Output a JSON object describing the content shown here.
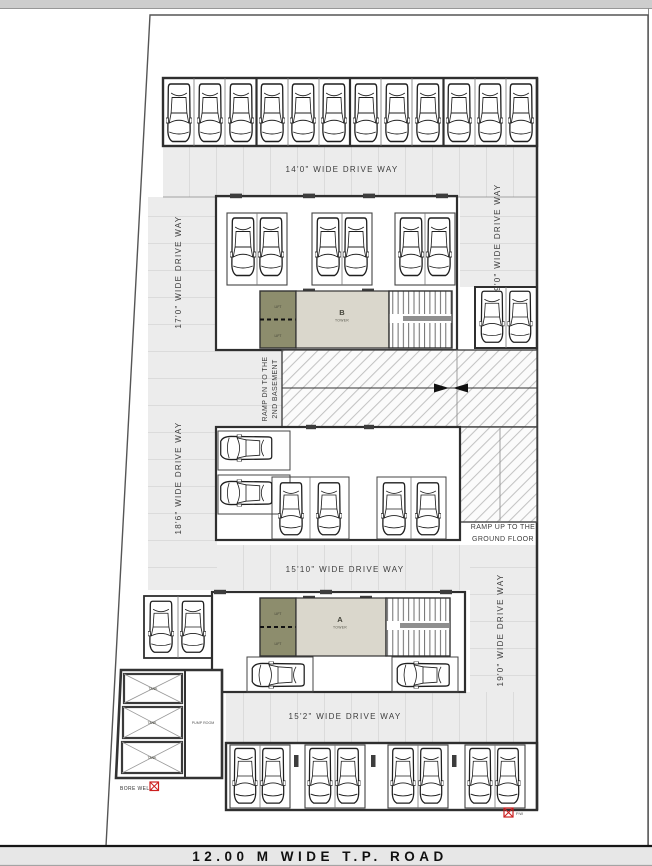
{
  "site": {
    "road_label": "12.00 M WIDE T.P. ROAD",
    "driveways": {
      "top": "14'0\" WIDE DRIVE WAY",
      "left_upper": "17'0\" WIDE DRIVE WAY",
      "left_lower": "18'6\" WIDE DRIVE WAY",
      "right_upper": "19'0\" WIDE DRIVE WAY",
      "right_lower": "19'0\" WIDE DRIVE WAY",
      "middle": "15'10\" WIDE DRIVE WAY",
      "bottom": "15'2\" WIDE DRIVE WAY"
    },
    "ramps": {
      "down_line1": "RAMP DN TO THE",
      "down_line2": "2ND BASEMENT",
      "up_line1": "RAMP UP TO THE",
      "up_line2": "GROUND FLOOR"
    },
    "towers": {
      "b_letter": "B",
      "b_sub": "TOWER",
      "a_letter": "A",
      "a_sub": "TOWER"
    },
    "rooms": {
      "lift": "LIFT",
      "pump_room": "PUMP ROOM",
      "tank1": "TANK",
      "tank2": "TANK",
      "tank3": "TANK"
    },
    "markers": {
      "bore_well": "BORE WELL",
      "pw": "P.W"
    },
    "colors": {
      "driveway": "#ececec",
      "lift_block": "#8d8d6d",
      "lobby": "#dad7cc",
      "marker_red": "#cc1f1f",
      "wall": "#2f2f2f"
    },
    "parking": {
      "total_cars": 38,
      "cars": [
        [
          179,
          113,
          26,
          62,
          0
        ],
        [
          210,
          113,
          26,
          62,
          0
        ],
        [
          241,
          113,
          26,
          62,
          0
        ],
        [
          272,
          113,
          26,
          62,
          0
        ],
        [
          303,
          113,
          26,
          62,
          0
        ],
        [
          334,
          113,
          26,
          62,
          0
        ],
        [
          366,
          113,
          26,
          62,
          0
        ],
        [
          397,
          113,
          26,
          62,
          0
        ],
        [
          428,
          113,
          26,
          62,
          0
        ],
        [
          459,
          113,
          26,
          62,
          0
        ],
        [
          490,
          113,
          26,
          62,
          0
        ],
        [
          521,
          113,
          26,
          62,
          0
        ],
        [
          243,
          247,
          26,
          62,
          0
        ],
        [
          271,
          247,
          26,
          62,
          0
        ],
        [
          328,
          247,
          26,
          62,
          0
        ],
        [
          356,
          247,
          26,
          62,
          0
        ],
        [
          411,
          247,
          26,
          62,
          0
        ],
        [
          439,
          247,
          26,
          62,
          0
        ],
        [
          492,
          317,
          25,
          55,
          0
        ],
        [
          520,
          317,
          25,
          55,
          0
        ],
        [
          246,
          448,
          27,
          55,
          90
        ],
        [
          246,
          493,
          27,
          55,
          90
        ],
        [
          291,
          509,
          26,
          56,
          0
        ],
        [
          329,
          509,
          26,
          56,
          0
        ],
        [
          394,
          509,
          26,
          56,
          0
        ],
        [
          428,
          509,
          26,
          56,
          0
        ],
        [
          161,
          627,
          26,
          55,
          0
        ],
        [
          193,
          627,
          26,
          55,
          0
        ],
        [
          278,
          675,
          27,
          56,
          90
        ],
        [
          423,
          675,
          27,
          56,
          90
        ],
        [
          245,
          776,
          25,
          59,
          0
        ],
        [
          273,
          776,
          25,
          59,
          0
        ],
        [
          320,
          776,
          25,
          59,
          0
        ],
        [
          348,
          776,
          25,
          59,
          0
        ],
        [
          403,
          776,
          25,
          59,
          0
        ],
        [
          431,
          776,
          25,
          59,
          0
        ],
        [
          480,
          776,
          25,
          59,
          0
        ],
        [
          508,
          776,
          25,
          59,
          0
        ]
      ]
    }
  }
}
